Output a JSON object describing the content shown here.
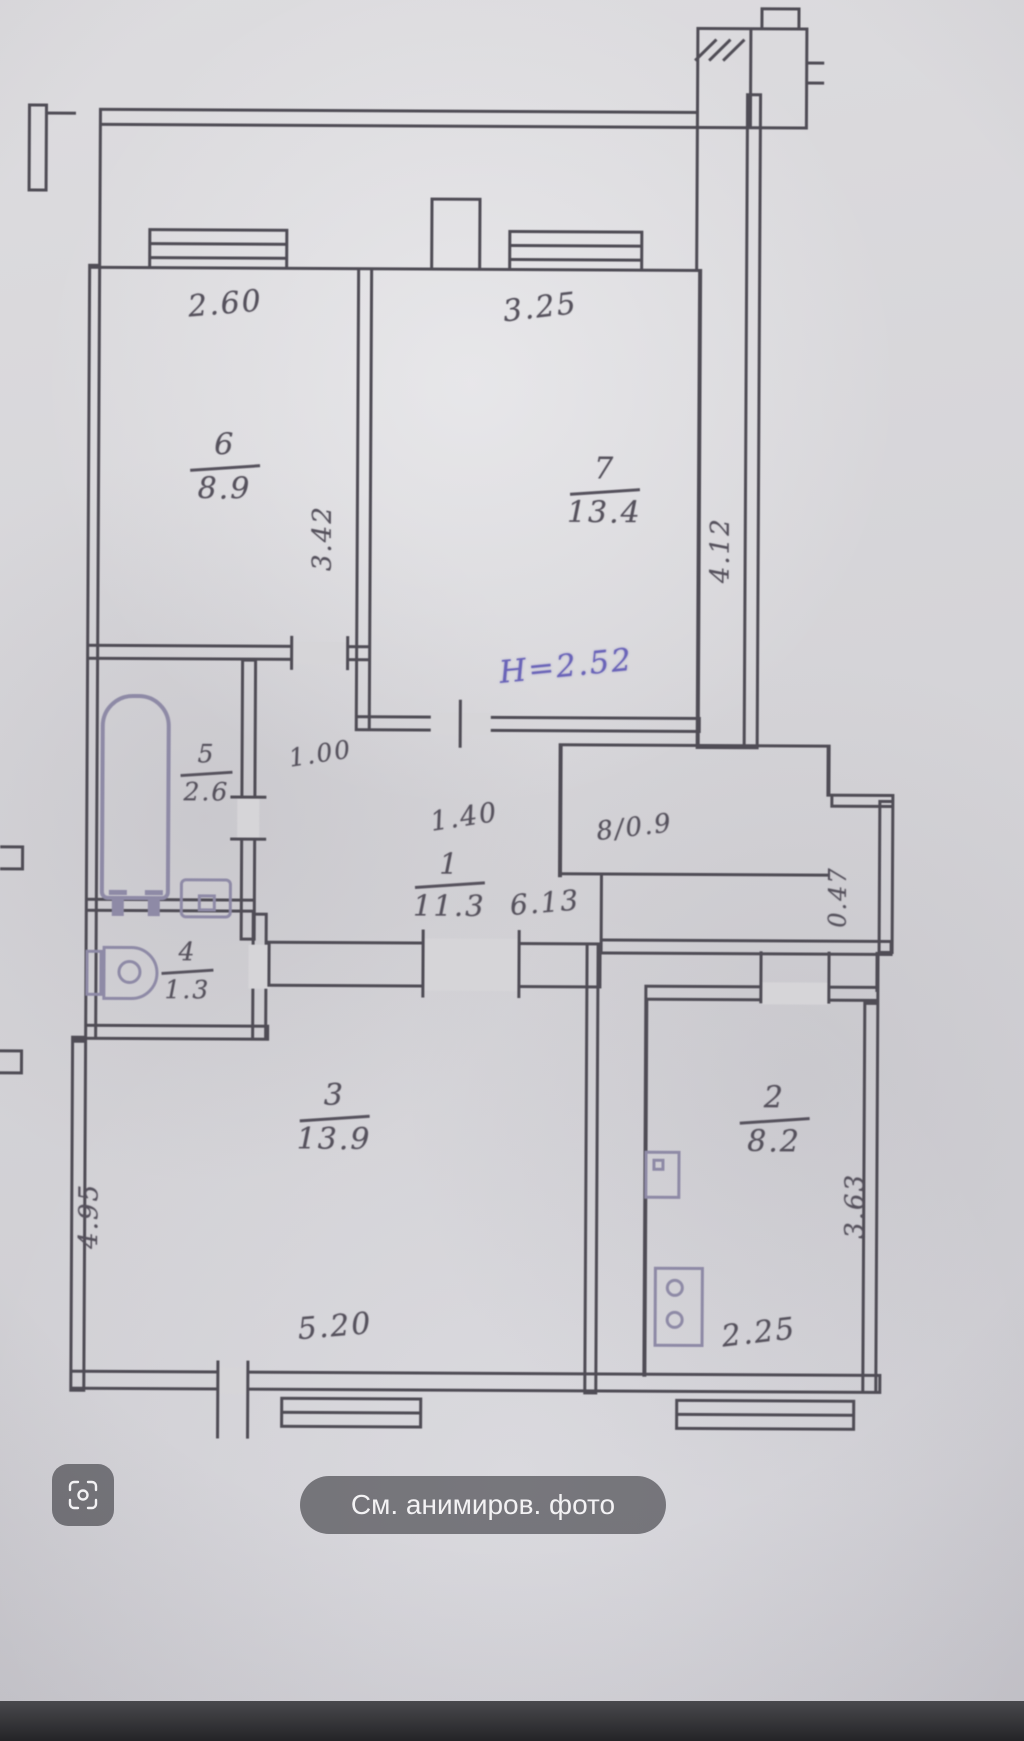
{
  "ui": {
    "chip_label": "См. анимиров. фото",
    "scan_icon": "animate-photo-icon"
  },
  "colors": {
    "ink": "#55515c",
    "fixture_ink": "#8e8aa6",
    "height_note_ink": "#6a64b8",
    "chip_bg": "rgba(38,38,43,0.55)"
  },
  "plan": {
    "height_note": {
      "text": "Н=2.52"
    },
    "closet": {
      "label": "8/0.9"
    },
    "rooms": [
      {
        "number": "6",
        "area": "8.9"
      },
      {
        "number": "7",
        "area": "13.4"
      },
      {
        "number": "5",
        "area": "2.6"
      },
      {
        "number": "4",
        "area": "1.3"
      },
      {
        "number": "1",
        "area": "11.3"
      },
      {
        "number": "3",
        "area": "13.9"
      },
      {
        "number": "2",
        "area": "8.2"
      }
    ],
    "dims": {
      "top_room6": "2.60",
      "top_room7": "3.25",
      "room6_side": "3.42",
      "room7_side": "4.12",
      "bath_door": "1.00",
      "hall_opening": "1.40",
      "hall_width": "6.13",
      "nook": "0.47",
      "room3_side": "4.95",
      "room3_width": "5.20",
      "room2_width": "2.25",
      "room2_side": "3.63"
    }
  }
}
